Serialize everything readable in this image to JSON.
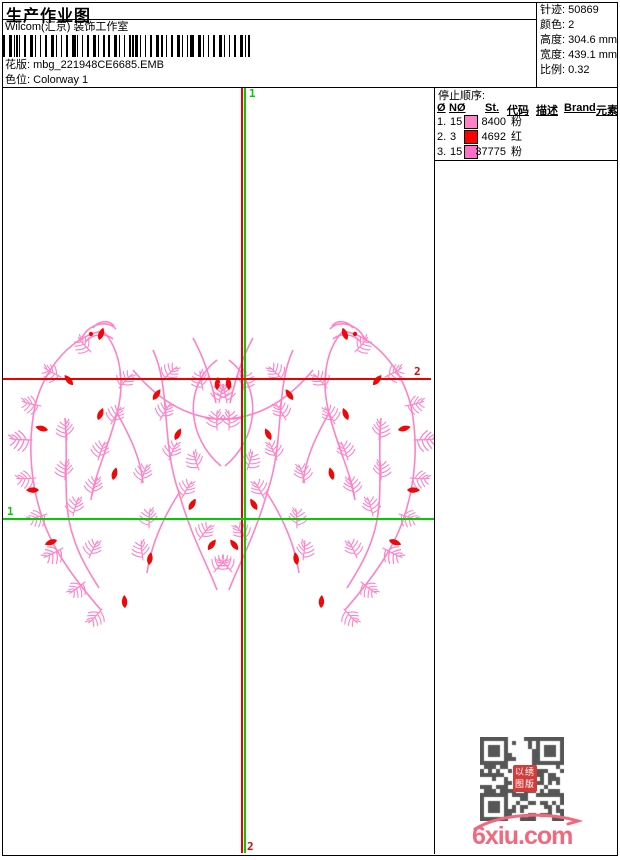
{
  "header": {
    "title": "生产作业图",
    "company": "Wilcom(汇京) 装饰工作室",
    "design_label": "花版:",
    "design_value": "mbg_221948CE6685.EMB",
    "colorway_label": "色位:",
    "colorway_value": "Colorway 1"
  },
  "info_panel": {
    "rows": [
      {
        "label": "针迹:",
        "value": "50869"
      },
      {
        "label": "颜色:",
        "value": "2"
      },
      {
        "label": "高度:",
        "value": "304.6 mm"
      },
      {
        "label": "宽度:",
        "value": "439.1 mm"
      },
      {
        "label": "比例:",
        "value": "0.32"
      }
    ]
  },
  "stop_sequence": {
    "title": "停止顺序:",
    "columns": [
      "Ø",
      "NØ",
      "St.",
      "代码",
      "描述",
      "Brand",
      "元素"
    ],
    "rows": [
      {
        "seq": "1.",
        "needle": "15",
        "swatch": "#FF82C8",
        "stitches": "8400",
        "code": "粉",
        "description": "",
        "brand": "",
        "elements": ""
      },
      {
        "seq": "2.",
        "needle": "3",
        "swatch": "#FF0000",
        "stitches": "4692",
        "code": "红",
        "description": "",
        "brand": "",
        "elements": ""
      },
      {
        "seq": "3.",
        "needle": "15",
        "swatch": "#FF6EC8",
        "stitches": "37775",
        "code": "粉",
        "description": "",
        "brand": "",
        "elements": ""
      }
    ]
  },
  "guides": {
    "green_color": "#00CC00",
    "red_color": "#EE0000",
    "vertical_start_label": "1",
    "vertical_end_label": "2",
    "horizontal_green_label": "1",
    "horizontal_red_label": "2"
  },
  "design": {
    "thread_pink": "#FF82C8",
    "thread_red": "#EE0808"
  },
  "watermark": {
    "site": "6xiu.com",
    "site_color": "#F2697E",
    "stamp_chars": "以绣图版"
  }
}
